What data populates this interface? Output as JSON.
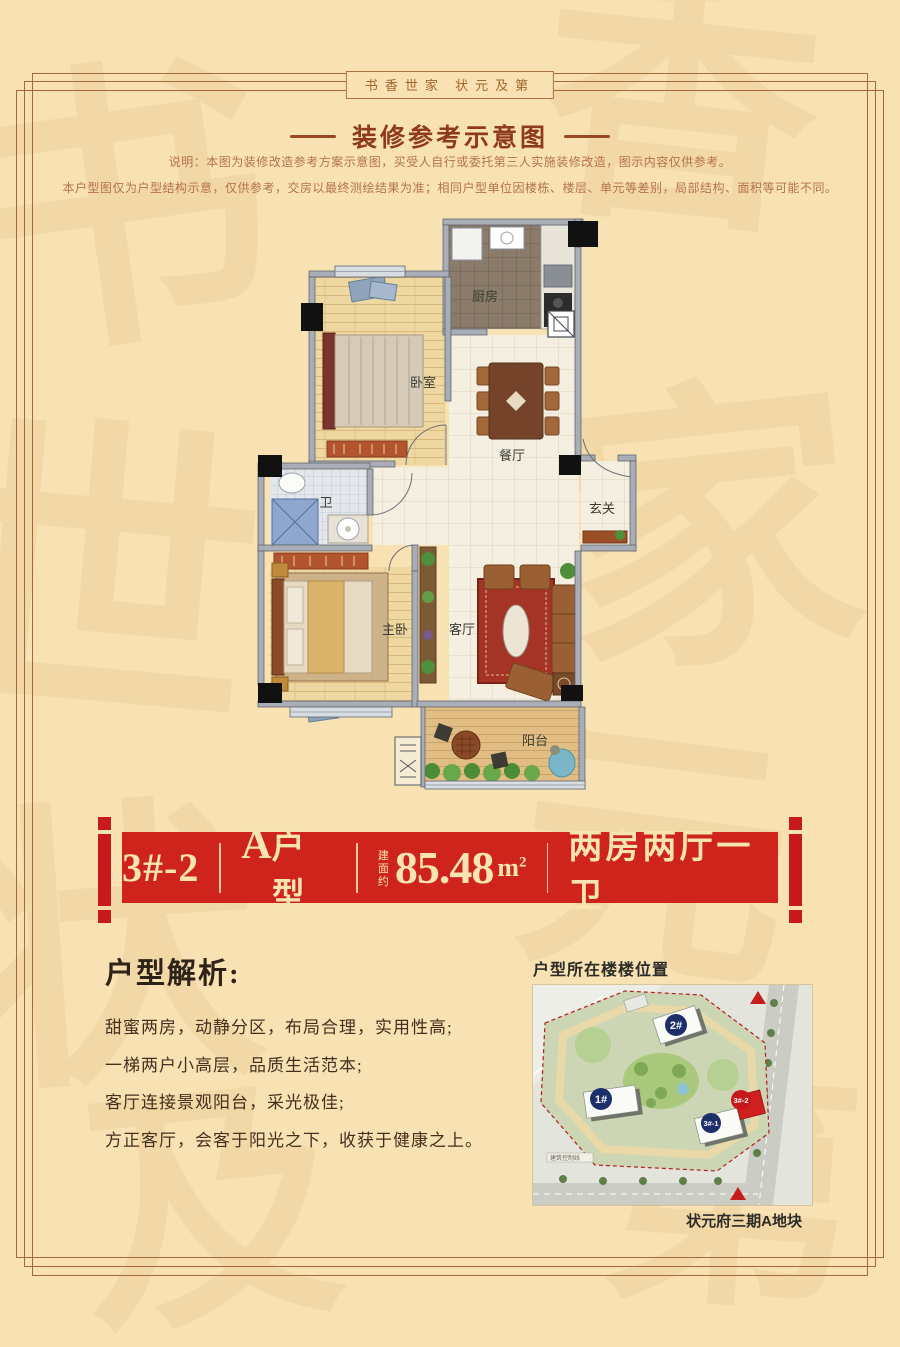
{
  "page": {
    "bg": "#f8e2b4",
    "frame_color": "#a5683a"
  },
  "header": {
    "motto": "书香世家  状元及第",
    "title": "装修参考示意图",
    "note1": "说明：本图为装修改造参考方案示意图，买受人自行或委托第三人实施装修改造，图示内容仅供参考。",
    "note2": "本户型图仅为户型结构示意，仅供参考，交房以最终测绘结果为准；相同户型单位因楼栋、楼层、单元等差别，局部结构、面积等可能不同。"
  },
  "floorplan": {
    "rooms": {
      "kitchen": "厨房",
      "bedroom": "卧室",
      "dining": "餐厅",
      "bath": "卫",
      "entry": "玄关",
      "master": "主卧",
      "living": "客厅",
      "balcony": "阳台"
    }
  },
  "banner": {
    "unit_no": "3#-2",
    "type_letter": "A",
    "type_suffix": "户型",
    "area_prefix": "建面约",
    "area_value": "85.48",
    "area_unit": "m",
    "area_sup": "2",
    "layout_label": "两房两厅一卫",
    "bg": "#ce241c",
    "text_color": "#f7e4b0"
  },
  "analysis": {
    "heading": "户型解析:",
    "lines": [
      "甜蜜两房，动静分区，布局合理，实用性高;",
      "一梯两户小高层，品质生活范本;",
      "客厅连接景观阳台，采光极佳;",
      "方正客厅，会客于阳光之下，收获于健康之上。"
    ]
  },
  "site_map": {
    "title": "户型所在楼楼位置",
    "caption": "状元府三期A地块",
    "note": "建筑控制线",
    "badges": [
      {
        "label": "1#",
        "color": "#1d2f6b"
      },
      {
        "label": "2#",
        "color": "#1d2f6b"
      },
      {
        "label": "3#-1",
        "color": "#1d2f6b"
      },
      {
        "label": "3#-2",
        "color": "#c8161d"
      }
    ]
  },
  "watermark": {
    "chars": [
      "书",
      "香",
      "世",
      "家",
      "状",
      "元",
      "及",
      "第"
    ]
  }
}
